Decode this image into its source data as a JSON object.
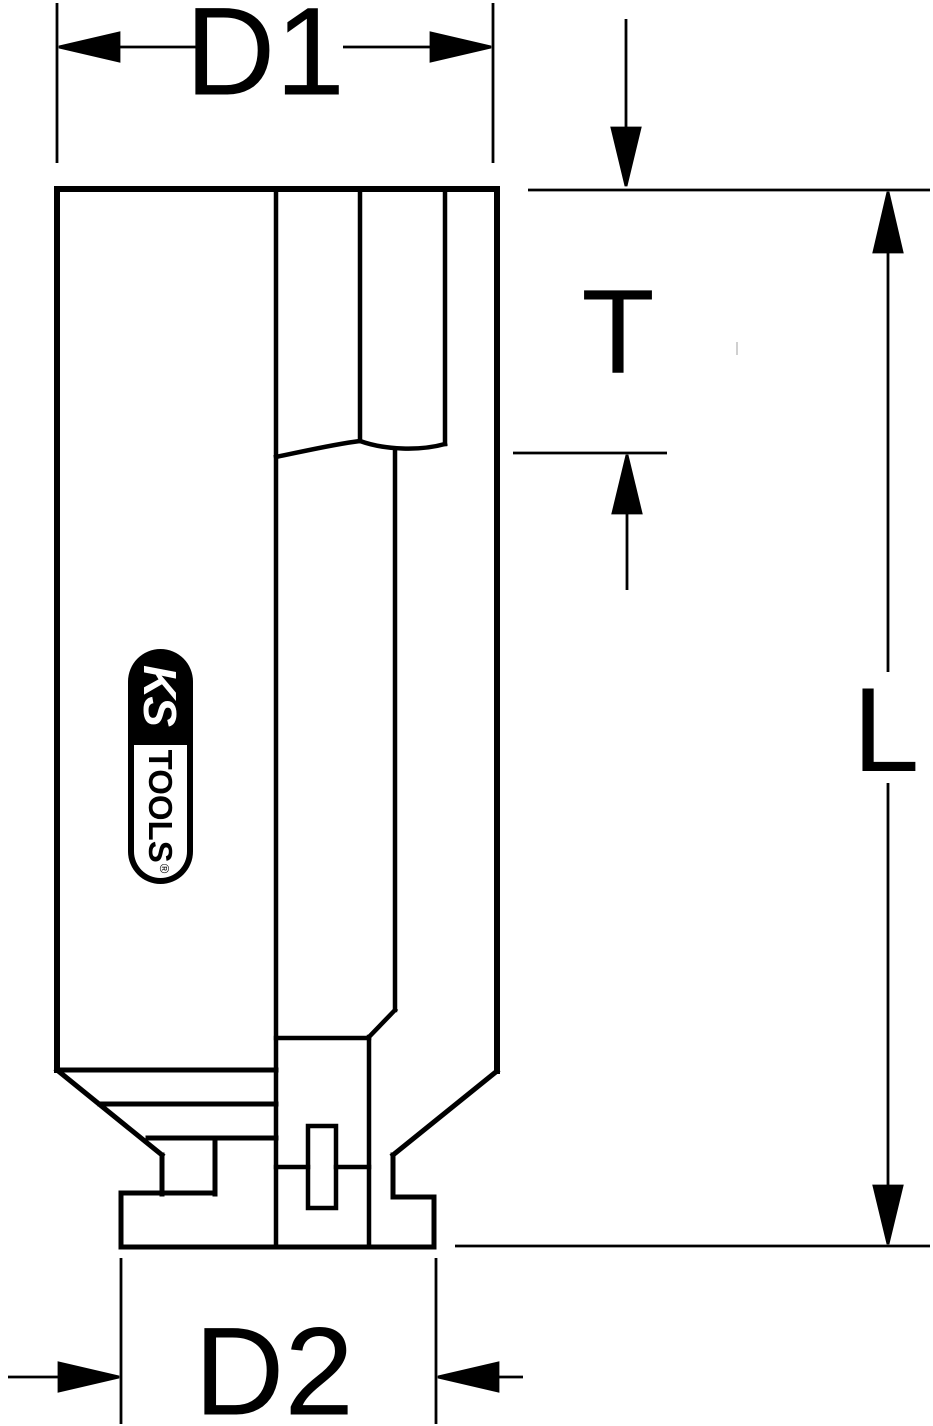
{
  "page": {
    "type": "technical-dimension-drawing",
    "subject": "impact-socket-side-section-view",
    "background_color": "#ffffff",
    "line_color": "#000000"
  },
  "dimensions": {
    "d1_label": "D1",
    "t_label": "T",
    "l_label": "L",
    "d2_label": "D2"
  },
  "logo": {
    "brand_top": "KS",
    "brand_bottom": "TOOLS",
    "registered_mark": "®",
    "capsule_bg": "#000000",
    "capsule_fg": "#ffffff"
  }
}
